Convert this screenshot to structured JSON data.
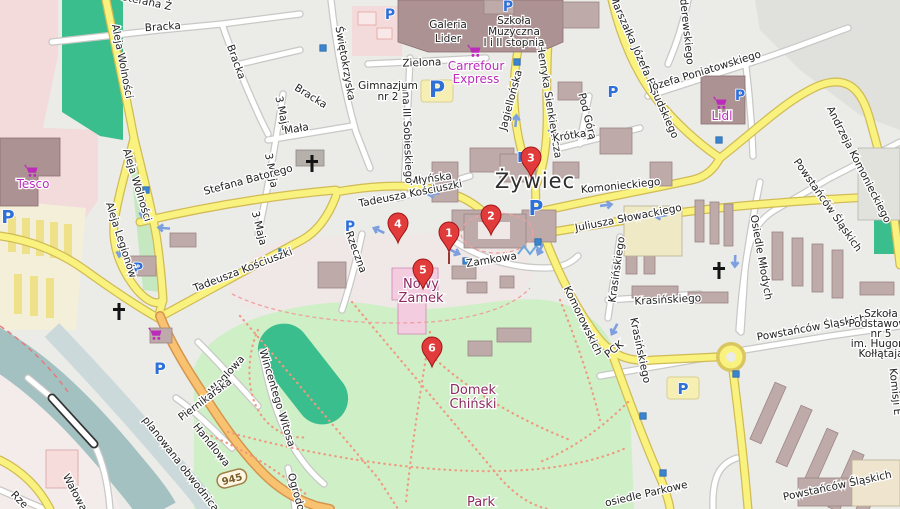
{
  "town_label": {
    "text": "Żywiec",
    "x": 535,
    "y": 188
  },
  "markers": [
    {
      "number": "1",
      "x": 449,
      "y": 252,
      "stem": true
    },
    {
      "number": "2",
      "x": 491,
      "y": 235,
      "stem": false
    },
    {
      "number": "3",
      "x": 531,
      "y": 177,
      "stem": false
    },
    {
      "number": "4",
      "x": 398,
      "y": 243,
      "stem": false
    },
    {
      "number": "5",
      "x": 423,
      "y": 289,
      "stem": false
    },
    {
      "number": "6",
      "x": 432,
      "y": 367,
      "stem": false
    }
  ],
  "street_labels": [
    {
      "text": "Bracka",
      "x": 163,
      "y": 30,
      "r": -4
    },
    {
      "text": "Bracka",
      "x": 233,
      "y": 63,
      "r": 70
    },
    {
      "text": "Bracka",
      "x": 309,
      "y": 99,
      "r": 32
    },
    {
      "text": "3 Maja",
      "x": 279,
      "y": 114,
      "r": 78
    },
    {
      "text": "Mała",
      "x": 297,
      "y": 132,
      "r": -10
    },
    {
      "text": "3 Maja",
      "x": 268,
      "y": 171,
      "r": 80
    },
    {
      "text": "3 Maja",
      "x": 256,
      "y": 229,
      "r": 76
    },
    {
      "text": "Stefana Ż",
      "x": 146,
      "y": 5,
      "r": 12
    },
    {
      "text": "Aleja Wolności",
      "x": 119,
      "y": 62,
      "r": 79
    },
    {
      "text": "Aleja Wolności",
      "x": 134,
      "y": 186,
      "r": 73
    },
    {
      "text": "Aleja Legionów",
      "x": 118,
      "y": 241,
      "r": 72
    },
    {
      "text": "Świętokrzyska",
      "x": 342,
      "y": 64,
      "r": 80
    },
    {
      "text": "Stefana Batorego",
      "x": 249,
      "y": 183,
      "r": -15
    },
    {
      "text": "Tadeusza Kościuszki",
      "x": 244,
      "y": 273,
      "r": -21
    },
    {
      "text": "Tadeusza Kościuszki",
      "x": 411,
      "y": 197,
      "r": -11
    },
    {
      "text": "Młyńska",
      "x": 431,
      "y": 182,
      "r": -8
    },
    {
      "text": "Zielona",
      "x": 422,
      "y": 66,
      "r": -2
    },
    {
      "text": "Jana III Sobieskiego",
      "x": 404,
      "y": 133,
      "r": 88
    },
    {
      "text": "Rzeczna",
      "x": 353,
      "y": 253,
      "r": 70
    },
    {
      "text": "Zamkowa",
      "x": 492,
      "y": 263,
      "r": -9
    },
    {
      "text": "Jagiellońska",
      "x": 514,
      "y": 101,
      "r": -75
    },
    {
      "text": "Henryka Sienkiewicza",
      "x": 546,
      "y": 102,
      "r": 81
    },
    {
      "text": "Pod Górą",
      "x": 584,
      "y": 117,
      "r": 76
    },
    {
      "text": "Krótka",
      "x": 570,
      "y": 139,
      "r": -9
    },
    {
      "text": "Marszałka Józefa Piłsudskiego",
      "x": 641,
      "y": 68,
      "r": 66
    },
    {
      "text": "Paderewskiego",
      "x": 683,
      "y": 26,
      "r": 84
    },
    {
      "text": "Józefa Poniatowskiego",
      "x": 706,
      "y": 74,
      "r": -17
    },
    {
      "text": "Andrzeja Komonieckiego",
      "x": 856,
      "y": 166,
      "r": 63
    },
    {
      "text": "Komonieckiego",
      "x": 621,
      "y": 189,
      "r": -6
    },
    {
      "text": "Juliusza Słowackiego",
      "x": 629,
      "y": 221,
      "r": -11
    },
    {
      "text": "Komorowskich",
      "x": 580,
      "y": 322,
      "r": 64
    },
    {
      "text": "Powstańców Śląskich",
      "x": 825,
      "y": 207,
      "r": 55
    },
    {
      "text": "Powstańców Śląskich",
      "x": 812,
      "y": 331,
      "r": -10
    },
    {
      "text": "Powstańców Śląskich",
      "x": 838,
      "y": 489,
      "r": -12
    },
    {
      "text": "Osiedle Młodych",
      "x": 758,
      "y": 258,
      "r": 80
    },
    {
      "text": "Krasińskiego",
      "x": 620,
      "y": 270,
      "r": -82
    },
    {
      "text": "Krasińskiego",
      "x": 668,
      "y": 303,
      "r": -3
    },
    {
      "text": "Krasińskiego",
      "x": 637,
      "y": 351,
      "r": 78
    },
    {
      "text": "PCK",
      "x": 616,
      "y": 352,
      "r": -38
    },
    {
      "text": "osiedle Parkowe",
      "x": 647,
      "y": 497,
      "r": -13
    },
    {
      "text": "Komisji E",
      "x": 892,
      "y": 392,
      "r": 84
    },
    {
      "text": "Węglowa",
      "x": 229,
      "y": 377,
      "r": -48
    },
    {
      "text": "Piernikarska",
      "x": 207,
      "y": 402,
      "r": -37
    },
    {
      "text": "Wincentego Witosa",
      "x": 274,
      "y": 399,
      "r": 73
    },
    {
      "text": "Handlowa",
      "x": 209,
      "y": 447,
      "r": 51
    },
    {
      "text": "planowana obwodnica",
      "x": 178,
      "y": 466,
      "r": 52
    },
    {
      "text": "Wałowa",
      "x": 72,
      "y": 494,
      "r": 62
    },
    {
      "text": "Rze",
      "x": 17,
      "y": 502,
      "r": 46
    },
    {
      "text": "Ogrodowa",
      "x": 295,
      "y": 500,
      "r": 74
    }
  ],
  "poi_labels": [
    {
      "lines": [
        "Galeria",
        "Lider"
      ],
      "x": 448,
      "y0": 28,
      "lh": 14,
      "s": 12.5,
      "c": "#50463e"
    },
    {
      "lines": [
        "Szkoła",
        "Muzyczna",
        "I i II stopnia"
      ],
      "x": 514,
      "y0": 24,
      "lh": 11,
      "s": 10.5,
      "c": "#222222"
    },
    {
      "lines": [
        "Gimnazjum",
        "nr 2"
      ],
      "x": 388,
      "y0": 89,
      "lh": 11,
      "s": 10.5,
      "c": "#222222"
    },
    {
      "lines": [
        "Szkoła",
        "Podstawowa",
        "nr 5",
        "im. Hugona",
        "Kołłątaja"
      ],
      "x": 881,
      "y0": 317,
      "lh": 10,
      "s": 9.5,
      "c": "#222222"
    }
  ],
  "shop_labels": [
    {
      "lines": [
        "Tesco"
      ],
      "x": 33,
      "y0": 188,
      "lh": 12,
      "cart": [
        33,
        172
      ]
    },
    {
      "lines": [
        "Carrefour",
        "Express"
      ],
      "x": 476,
      "y0": 70,
      "lh": 13,
      "cart": [
        476,
        52
      ]
    },
    {
      "lines": [
        "Lidl"
      ],
      "x": 722,
      "y0": 120,
      "lh": 12,
      "cart": [
        722,
        104
      ]
    }
  ],
  "tourism_labels": [
    {
      "lines": [
        "Nowy",
        "Zamek"
      ],
      "x": 421,
      "y0": 288,
      "lh": 14
    },
    {
      "lines": [
        "Domek",
        "Chiński"
      ],
      "x": 473,
      "y0": 394,
      "lh": 14
    },
    {
      "lines": [
        "Park"
      ],
      "x": 481,
      "y0": 506,
      "lh": 14
    }
  ],
  "route_shield": {
    "text": "945",
    "x": 232,
    "y": 479,
    "r": -15
  },
  "icons": {
    "parking": [
      {
        "x": 390,
        "y": 14,
        "s": 14
      },
      {
        "x": 508,
        "y": 6,
        "s": 14
      },
      {
        "x": 613,
        "y": 92,
        "s": 15
      },
      {
        "x": 740,
        "y": 95,
        "s": 14
      },
      {
        "x": 437,
        "y": 92,
        "s": 22,
        "bg": true
      },
      {
        "x": 8,
        "y": 218,
        "s": 18
      },
      {
        "x": 138,
        "y": 268,
        "s": 14
      },
      {
        "x": 350,
        "y": 226,
        "s": 14
      },
      {
        "x": 536,
        "y": 210,
        "s": 20
      },
      {
        "x": 160,
        "y": 369,
        "s": 16
      },
      {
        "x": 683,
        "y": 389,
        "s": 15,
        "bg": true
      },
      {
        "x": 522,
        "y": 157,
        "s": 13
      }
    ],
    "bus_stops": [
      [
        323,
        48
      ],
      [
        517,
        62
      ],
      [
        719,
        140
      ],
      [
        146,
        190
      ],
      [
        282,
        252
      ],
      [
        466,
        261
      ],
      [
        538,
        242
      ],
      [
        643,
        416
      ],
      [
        663,
        473
      ],
      [
        736,
        374
      ]
    ],
    "churches": [
      [
        119,
        311
      ],
      [
        312,
        163
      ],
      [
        719,
        270
      ]
    ],
    "carts": [
      [
        157,
        335
      ]
    ],
    "oneway_arrows": [
      [
        163,
        228,
        185
      ],
      [
        433,
        194,
        173
      ],
      [
        378,
        230,
        205
      ],
      [
        552,
        130,
        95
      ],
      [
        516,
        120,
        -85
      ],
      [
        607,
        205,
        -8
      ],
      [
        660,
        216,
        172
      ],
      [
        540,
        250,
        115
      ],
      [
        614,
        330,
        118
      ],
      [
        735,
        262,
        92
      ],
      [
        120,
        252,
        100
      ],
      [
        143,
        213,
        100
      ],
      [
        455,
        252,
        25
      ]
    ]
  },
  "colors": {
    "marker_red": "#e23b3b",
    "marker_border": "#a01515",
    "parking_blue": "#2e6fd8",
    "shop_purple": "#bb2cbb",
    "tourism_label": "#8e2960",
    "road_yellow": "#faf27e",
    "road_orange": "#f9c270",
    "water": "#a3c1c1",
    "park_green": "#cfefc7",
    "pitch_green": "#3bbe8d",
    "retail_pink": "#f2dbda",
    "land": "#ebebe8"
  }
}
